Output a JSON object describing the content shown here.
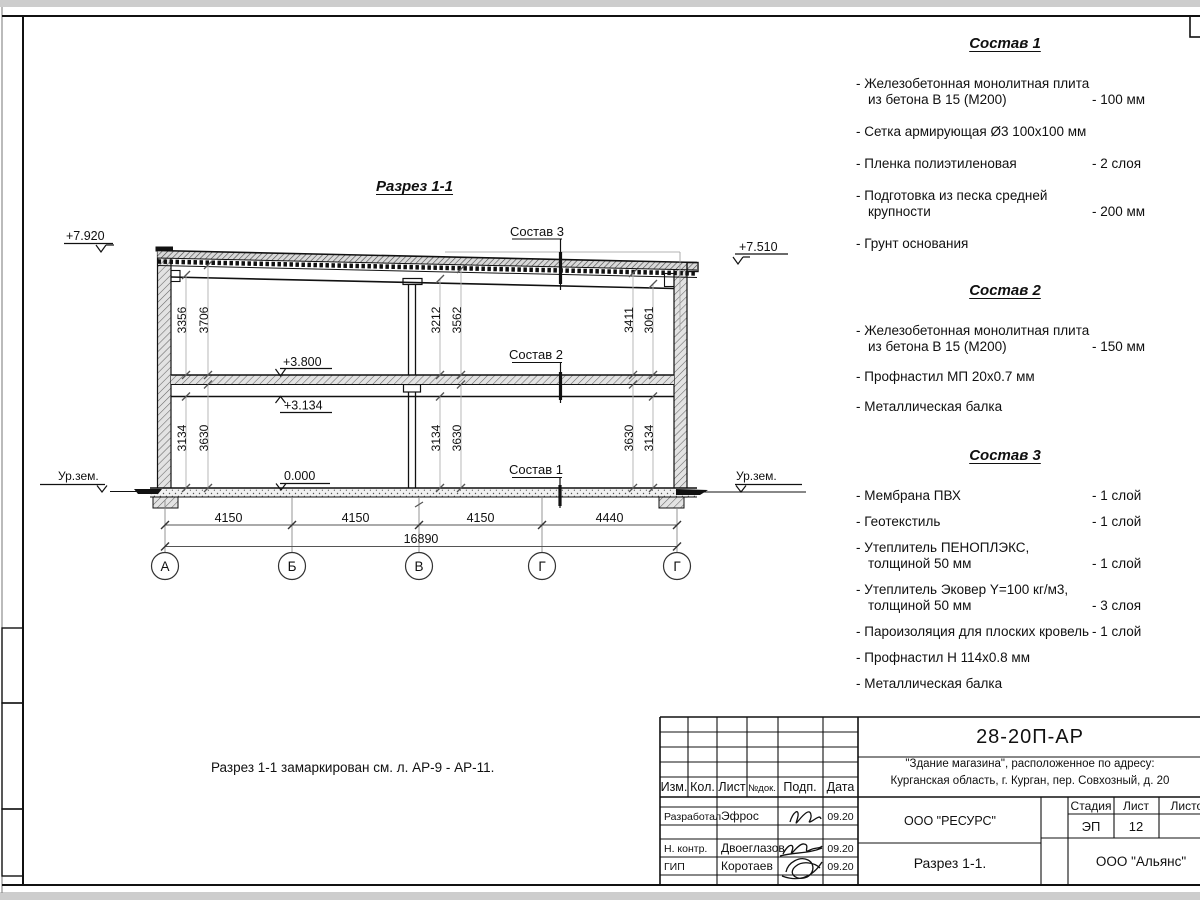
{
  "page": {
    "drawing_title": "Разрез 1-1",
    "note": "Разрез 1-1 замаркирован см. л. АР-9 - АР-11."
  },
  "compositions": [
    {
      "title": "Состав 1",
      "items": [
        {
          "text": "- Железобетонная монолитная плита\nиз бетона В 15 (М200)",
          "value": "- 100 мм"
        },
        {
          "text": "- Сетка армирующая Ø3 100х100 мм",
          "value": ""
        },
        {
          "text": "- Пленка полиэтиленовая",
          "value": "- 2 слоя"
        },
        {
          "text": "- Подготовка из песка средней\nкрупности",
          "value": "- 200 мм"
        },
        {
          "text": "- Грунт основания",
          "value": ""
        }
      ]
    },
    {
      "title": "Состав 2",
      "items": [
        {
          "text": "- Железобетонная монолитная плита\nиз бетона В 15 (М200)",
          "value": "- 150 мм"
        },
        {
          "text": "- Профнастил МП 20х0.7 мм",
          "value": ""
        },
        {
          "text": "- Металлическая балка",
          "value": ""
        }
      ]
    },
    {
      "title": "Состав 3",
      "items": [
        {
          "text": "- Мембрана ПВХ",
          "value": "- 1 слой"
        },
        {
          "text": "- Геотекстиль",
          "value": "- 1 слой"
        },
        {
          "text": "- Утеплитель ПЕНОПЛЭКС,\nтолщиной 50 мм",
          "value": "- 1 слой"
        },
        {
          "text": "- Утеплитель Эковер Y=100 кг/м3,\nтолщиной 50 мм",
          "value": "- 3 слоя"
        },
        {
          "text": "- Пароизоляция для плоских кровель",
          "value": "- 1 слой"
        },
        {
          "text": "- Профнастил Н 114х0.8 мм",
          "value": ""
        },
        {
          "text": "- Металлическая балка",
          "value": ""
        }
      ]
    }
  ],
  "drawing": {
    "elevations": {
      "roof_left": "+7.920",
      "roof_right": "+7.510",
      "floor": "+3.800",
      "beam": "+3.134",
      "ground": "0.000"
    },
    "ground_level_label": "Ур.зем.",
    "layer_callouts": [
      "Состав 3",
      "Состав 2",
      "Состав 1"
    ],
    "vertical_dims_upper": [
      "3356",
      "3706",
      "3212",
      "3562",
      "3411",
      "3061"
    ],
    "vertical_dims_lower": [
      "3134",
      "3630",
      "3134",
      "3630",
      "3630",
      "3134"
    ],
    "span_dims": [
      "4150",
      "4150",
      "4150",
      "4440"
    ],
    "total_dim": "16890",
    "axes": [
      "А",
      "Б",
      "В",
      "Г",
      "Г"
    ]
  },
  "stamp": {
    "doc_number": "28-20П-АР",
    "object_line1": "\"Здание магазина\", расположенное по адресу:",
    "object_line2": "Курганская область, г. Курган, пер. Совхозный, д. 20",
    "rev_headers": [
      "Изм.",
      "Кол.",
      "Лист",
      "№док.",
      "Подп.",
      "Дата"
    ],
    "signers": [
      {
        "role": "Разработал",
        "name": "Эфрос",
        "date": "09.20"
      },
      {
        "role": "Н. контр.",
        "name": "Двоеглазов",
        "date": "09.20"
      },
      {
        "role": "ГИП",
        "name": "Коротаев",
        "date": "09.20"
      }
    ],
    "designer_org": "ООО \"РЕСУРС\"",
    "stage_label": "Стадия",
    "sheet_label": "Лист",
    "sheets_label": "Листов",
    "stage": "ЭП",
    "sheet_number": "12",
    "section_name": "Разрез 1-1.",
    "client_org": "ООО \"Альянс\""
  }
}
